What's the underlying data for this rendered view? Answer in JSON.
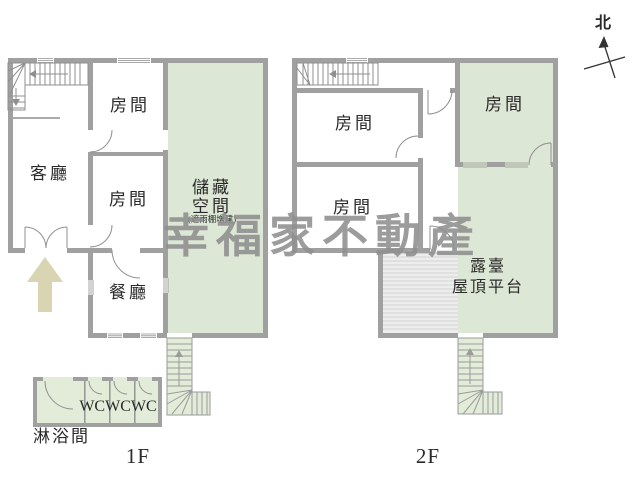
{
  "watermark": "幸福家不動產",
  "compass": {
    "label": "北"
  },
  "floor1": {
    "floor_label": "1F",
    "rooms": {
      "living": "客廳",
      "room_top": "房間",
      "room_mid": "房間",
      "dining": "餐廳",
      "storage": "儲藏\n空間",
      "storage_note": "(遮雨棚增建)",
      "wc": "WCWCWC",
      "shower": "淋浴間"
    }
  },
  "floor2": {
    "floor_label": "2F",
    "rooms": {
      "room_upper": "房間",
      "room_lower": "房間",
      "room_green": "房間",
      "terrace": "露臺\n屋頂平台"
    }
  },
  "colors": {
    "wall": "#a0a0a0",
    "thin_line": "#8f8f8f",
    "green_area": "#dce8d5",
    "stair_green": "#e2ecd9",
    "hatch_bg": "#ededed",
    "hatch_line": "#d2d2d2",
    "entrance_arrow": "#d9d5b2",
    "watermark_gray": "#8f8f8f",
    "text": "#2a2a2a"
  }
}
